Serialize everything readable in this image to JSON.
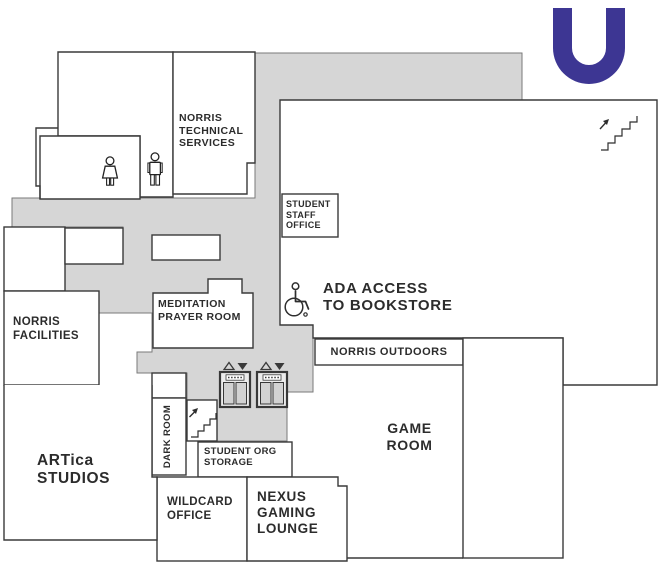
{
  "logo": {
    "letter": "U",
    "color": "#3d3693"
  },
  "palette": {
    "corridor_fill": "#d6d6d6",
    "wall": "#3a3a3a",
    "room_fill": "#ffffff",
    "text": "#2c2c2c"
  },
  "labels": {
    "norris_technical_services": "NORRIS\nTECHNICAL\nSERVICES",
    "student_staff_office": "STUDENT\nSTAFF\nOFFICE",
    "ada_access": "ADA ACCESS\nTO BOOKSTORE",
    "norris_outdoors": "NORRIS OUTDOORS",
    "meditation_prayer_room": "MEDITATION\nPRAYER ROOM",
    "norris_facilities": "NORRIS\nFACILITIES",
    "artica_studios": "ARTica\nSTUDIOS",
    "dark_room": "DARK ROOM",
    "student_org_storage": "STUDENT ORG\nSTORAGE",
    "wildcard_office": "WILDCARD\nOFFICE",
    "nexus_gaming_lounge": "NEXUS\nGAMING\nLOUNGE",
    "game_room": "GAME\nROOM"
  },
  "icons": {
    "womens_restroom": "womens-restroom-icon",
    "mens_restroom": "mens-restroom-icon",
    "wheelchair": "ada-wheelchair-icon",
    "elevator_1": "elevator-icon",
    "elevator_2": "elevator-icon",
    "stairs_lower": "stairs-up-icon",
    "stairs_bookstore": "stairs-up-icon",
    "logo": "university-u-logo"
  }
}
